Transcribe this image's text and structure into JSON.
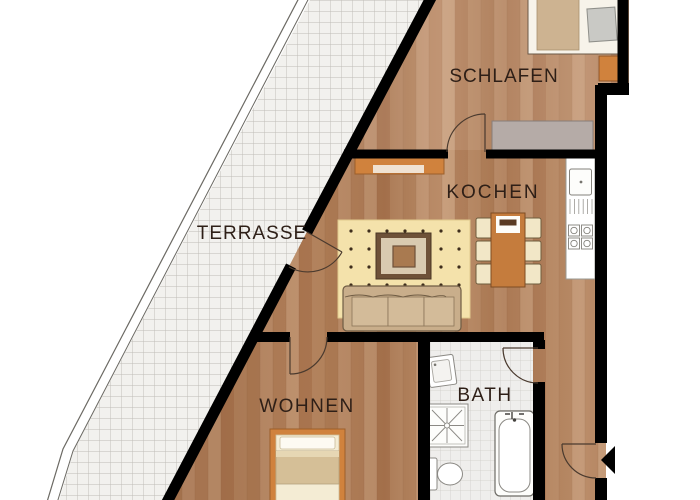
{
  "plan_type": "apartment-floor-plan",
  "labels": {
    "terrasse": "TERRASSE",
    "schlafen": "SCHLAFEN",
    "kochen": "KOCHEN",
    "wohnen": "WOHNEN",
    "bath": "BATH"
  },
  "rooms": [
    {
      "id": "terrasse",
      "label": "TERRASSE",
      "floor": "tile",
      "features": [
        "railing",
        "terrace-door"
      ]
    },
    {
      "id": "schlafen",
      "label": "SCHLAFEN",
      "floor": "wood",
      "features": [
        "double-bed",
        "pillow",
        "nightstand",
        "wardrobe",
        "room-door"
      ]
    },
    {
      "id": "kochen",
      "label": "KOCHEN",
      "floor": "wood",
      "features": [
        "kitchen-counter",
        "sink",
        "dishwasher",
        "stove",
        "sideboard",
        "dining-table",
        "chairs-x6",
        "rug",
        "coffee-table",
        "sofa"
      ]
    },
    {
      "id": "wohnen",
      "label": "WOHNEN",
      "floor": "wood",
      "features": [
        "single-bed",
        "room-door"
      ]
    },
    {
      "id": "bath",
      "label": "BATH",
      "floor": "tile",
      "features": [
        "washbasin",
        "shower",
        "toilet",
        "bathtub",
        "door"
      ]
    }
  ],
  "doors": [
    "terrace-door",
    "schlafen-door",
    "wohnen-door",
    "bath-door",
    "entrance-door"
  ],
  "colors": {
    "wall": "#000000",
    "wood_floor": "#b5855f",
    "terrace_tile_bg": "#f2f1ee",
    "tile_line": "#bdbbb6",
    "accent_orange": "#d0823d",
    "rug_yellow": "#f4e2ab",
    "sofa_tan": "#c9ae8b",
    "wardrobe_gray": "#b5aba7",
    "label_text": "#2e1f17"
  }
}
